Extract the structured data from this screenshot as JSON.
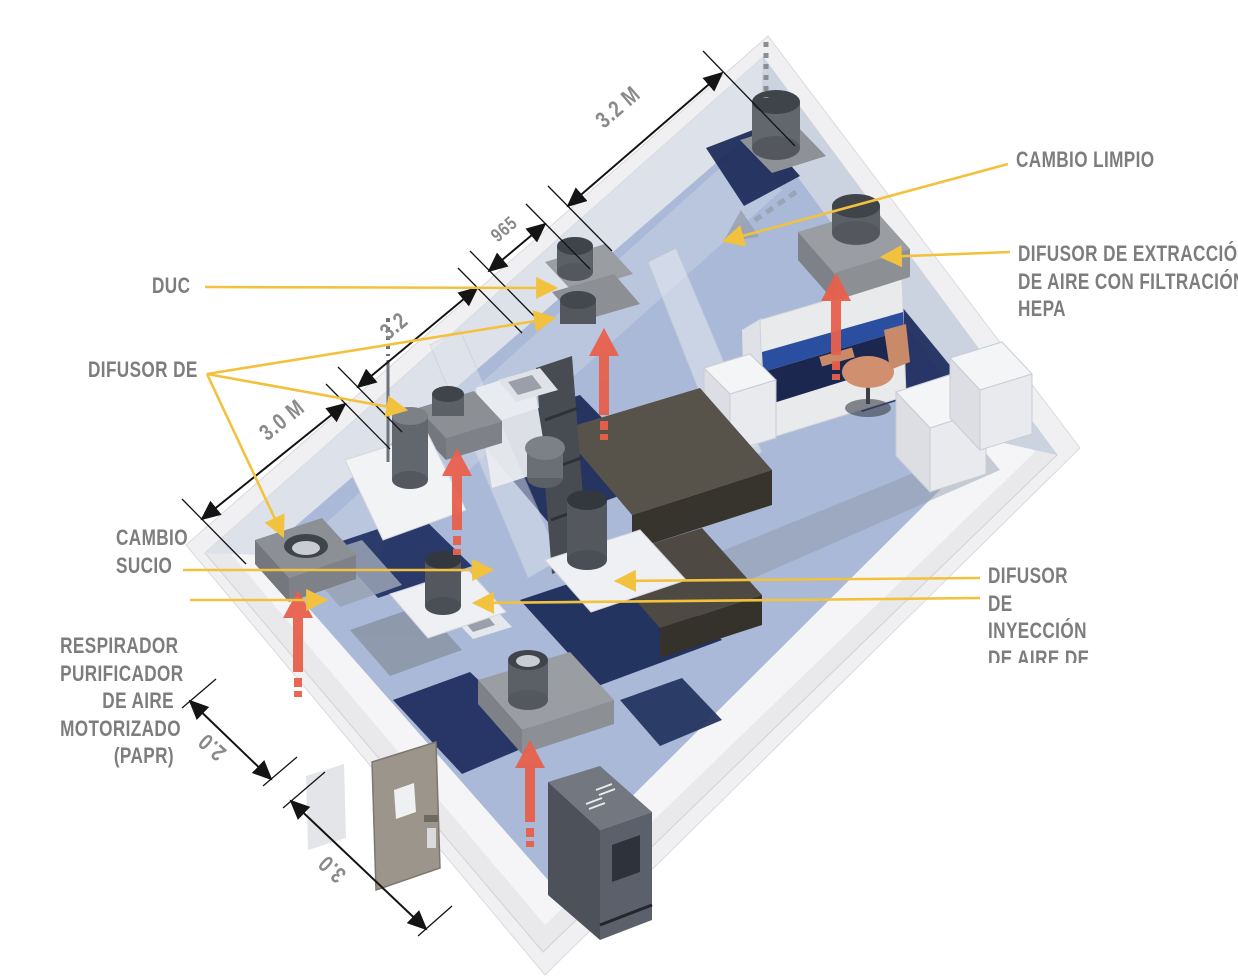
{
  "scene": {
    "description": "Isometric 3D render of a laboratory cleanroom with HVAC diffusers",
    "colors": {
      "label_text": "#7d7d7d",
      "leader_yellow": "#f2c23e",
      "dimension_black": "#141414",
      "flow_arrow_red": "#e8604c",
      "floor_light_blue": "#a9b9d7",
      "floor_dark_navy": "#1b2a58",
      "wall_translucent": "#93a6c8",
      "equipment_gray": "#8d9095",
      "equipment_white": "#f2f3f5",
      "bsc_stripe_blue": "#2b4fa0"
    }
  },
  "labels": {
    "duc": "DUC",
    "difusor_de": "DIFUSOR DE",
    "cambio_sucio": [
      "CAMBIO",
      "SUCIO"
    ],
    "respirador": [
      "RESPIRADOR",
      "PURIFICADOR",
      "DE AIRE",
      "MOTORIZADO",
      "(PAPR)"
    ],
    "cambio_limpio": "CAMBIO LIMPIO",
    "difusor_extraccion": [
      "DIFUSOR DE EXTRACCIÓN",
      "DE AIRE CON FILTRACIÓN",
      "HEPA"
    ],
    "difusor_inyeccion": [
      "DIFUSOR",
      "DE",
      "INYECCIÓN",
      "DE AIRE DE"
    ]
  },
  "dimensions": {
    "d32m": "3.2 M",
    "d965": "965",
    "d32": "3.2",
    "d30m": "3.0 M",
    "d20": "2.0",
    "d30": "3.0"
  }
}
